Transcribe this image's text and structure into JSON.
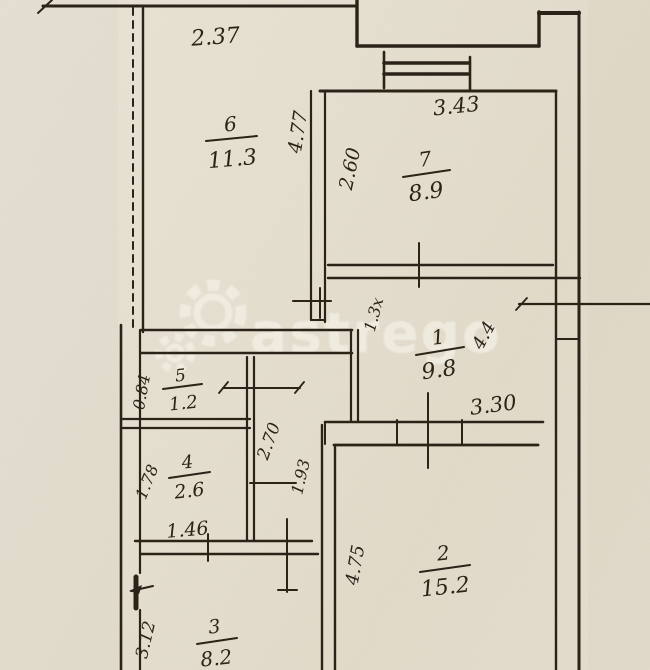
{
  "document_type": "hand-drawn apartment floor plan (scan)",
  "watermark": {
    "text": "astrego",
    "icon": "gear-icon"
  },
  "rooms": {
    "room1": {
      "number": "1",
      "area": "9.8"
    },
    "room2": {
      "number": "2",
      "area": "15.2"
    },
    "room3": {
      "number": "3",
      "area": "8.2"
    },
    "room4": {
      "number": "4",
      "area": "2.6"
    },
    "room5": {
      "number": "5",
      "area": "1.2"
    },
    "room6": {
      "number": "6",
      "area": "11.3"
    },
    "room7": {
      "number": "7",
      "area": "8.9"
    }
  },
  "dimensions": {
    "room6_width": "2.37",
    "room6_depth": "4.77",
    "room7_width": "3.43",
    "room7_depth": "2.60",
    "hall_upper_width": "1.3х",
    "hall_depth": "4.4",
    "hall_width": "3.30",
    "room5_depth": "0.84",
    "corridor_depth_a": "2.70",
    "corridor_depth_b": "1.93",
    "room4_depth": "1.78",
    "room4_width": "1.46",
    "room2_depth": "4.75",
    "room3_depth": "3.12"
  }
}
